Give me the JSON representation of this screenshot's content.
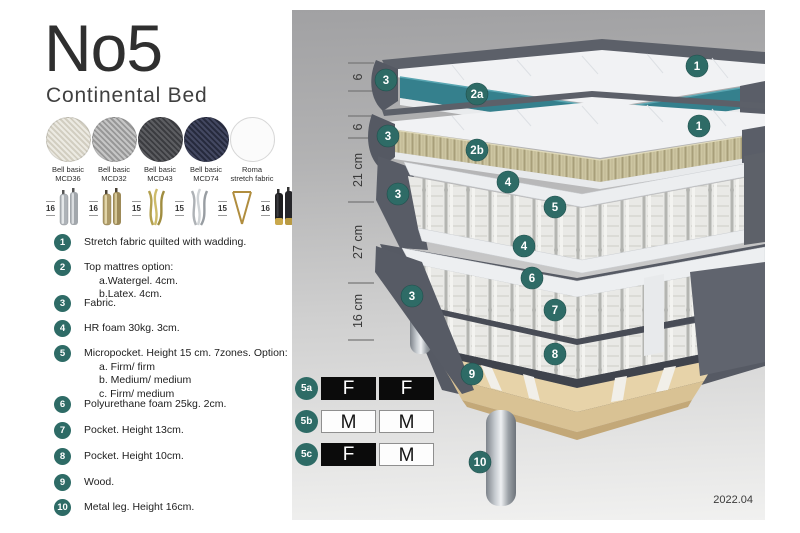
{
  "header": {
    "title": "No5",
    "subtitle": "Continental Bed"
  },
  "swatches": [
    {
      "line1": "Bell basic",
      "line2": "MCD36",
      "color": "#e4e1d7"
    },
    {
      "line1": "Bell basic",
      "line2": "MCD32",
      "color": "#b5b5b5"
    },
    {
      "line1": "Bell basic",
      "line2": "MCD43",
      "color": "#4d4e52"
    },
    {
      "line1": "Bell basic",
      "line2": "MCD74",
      "color": "#383c50"
    },
    {
      "line1": "Roma",
      "line2": "stretch fabric",
      "color": "#fbfbfb"
    }
  ],
  "legs": [
    {
      "height": "16",
      "style": "cylinder-silver"
    },
    {
      "height": "16",
      "style": "cylinder-gold"
    },
    {
      "height": "15",
      "style": "twisted-gold"
    },
    {
      "height": "15",
      "style": "twisted-silver"
    },
    {
      "height": "15",
      "style": "hairpin-gold"
    },
    {
      "height": "16",
      "style": "cylinder-black-gold"
    }
  ],
  "list": {
    "items": [
      {
        "num": "1",
        "text": "Stretch fabric quilted with wadding."
      },
      {
        "num": "2",
        "text": "Top mattres option:",
        "subs": [
          "a.Watergel. 4cm.",
          "b.Latex. 4cm."
        ]
      },
      {
        "num": "3",
        "text": "Fabric."
      },
      {
        "num": "4",
        "text": "HR foam 30kg. 3cm."
      },
      {
        "num": "5",
        "text": "Micropocket. Height 15 cm. 7zones. Option:",
        "subs": [
          "a. Firm/ firm",
          "b. Medium/ medium",
          "c. Firm/ medium"
        ]
      },
      {
        "num": "6",
        "text": "Polyurethane foam 25kg. 2cm."
      },
      {
        "num": "7",
        "text": "Pocket. Height 13cm."
      },
      {
        "num": "8",
        "text": "Pocket. Height 10cm."
      },
      {
        "num": "9",
        "text": "Wood."
      },
      {
        "num": "10",
        "text": "Metal leg. Height 16cm."
      }
    ]
  },
  "diagram": {
    "measurements": [
      "6",
      "6",
      "21 cm",
      "27 cm",
      "16 cm"
    ],
    "badges": [
      {
        "label": "1"
      },
      {
        "label": "3"
      },
      {
        "label": "2a"
      },
      {
        "label": "1"
      },
      {
        "label": "3"
      },
      {
        "label": "2b"
      },
      {
        "label": "3"
      },
      {
        "label": "4"
      },
      {
        "label": "5"
      },
      {
        "label": "4"
      },
      {
        "label": "3"
      },
      {
        "label": "6"
      },
      {
        "label": "7"
      },
      {
        "label": "8"
      },
      {
        "label": "9"
      },
      {
        "label": "10"
      }
    ],
    "date": "2022.04",
    "colors": {
      "badge": "#2e6b66",
      "watergel_teal": "#35808d",
      "latex_tan": "#cbc49f",
      "fabric_dark_gray": "#575b65",
      "wood": "#e7d3a9"
    }
  },
  "firmness": {
    "rows": [
      {
        "label": "5a",
        "cells": [
          "F",
          "F"
        ]
      },
      {
        "label": "5b",
        "cells": [
          "M",
          "M"
        ]
      },
      {
        "label": "5c",
        "cells": [
          "F",
          "M"
        ]
      }
    ]
  }
}
